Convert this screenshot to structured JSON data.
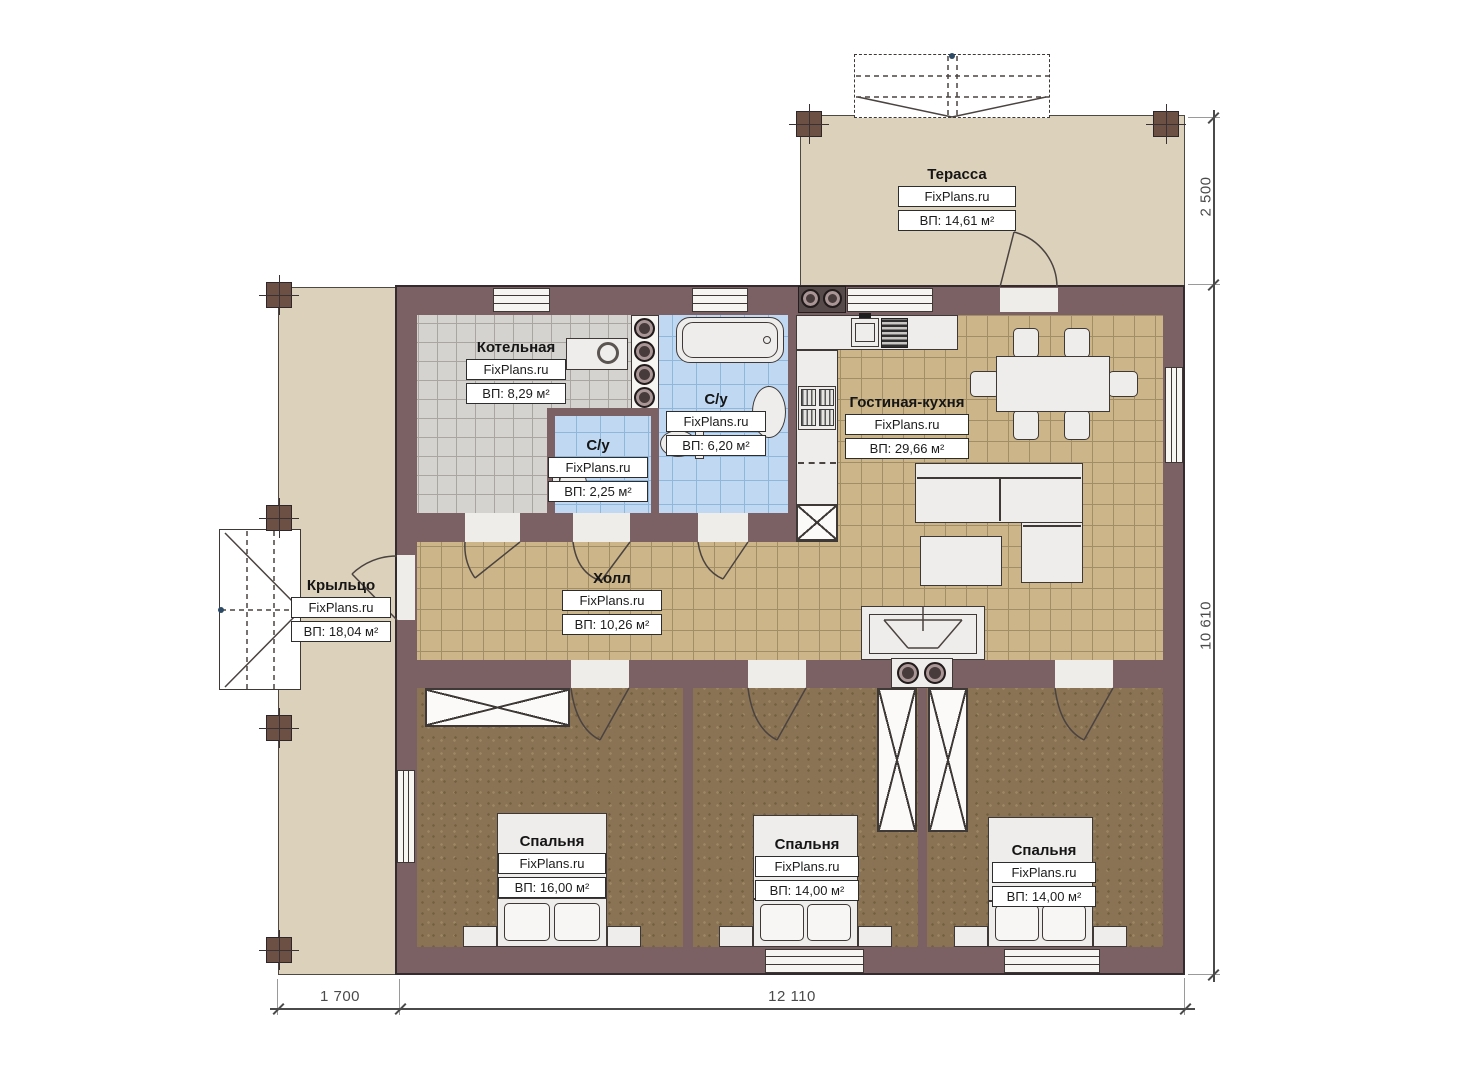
{
  "brand": "FixPlans.ru",
  "rooms": [
    {
      "name": "Терасса",
      "area": "ВП: 14,61 м²"
    },
    {
      "name": "Котельная",
      "area": "ВП: 8,29 м²"
    },
    {
      "name": "С/у",
      "area": "ВП: 6,20 м²"
    },
    {
      "name": "С/у",
      "area": "ВП: 2,25 м²"
    },
    {
      "name": "Гостиная-кухня",
      "area": "ВП: 29,66 м²"
    },
    {
      "name": "Холл",
      "area": "ВП: 10,26 м²"
    },
    {
      "name": "Крыльцо",
      "area": "ВП: 18,04 м²"
    },
    {
      "name": "Спальня",
      "area": "ВП: 16,00 м²"
    },
    {
      "name": "Спальня",
      "area": "ВП: 14,00 м²"
    },
    {
      "name": "Спальня",
      "area": "ВП: 14,00 м²"
    }
  ],
  "dimensions": {
    "terrace_depth": "2 500",
    "house_depth": "10 610",
    "porch_width": "1 700",
    "house_width": "12 110"
  },
  "colors": {
    "wall": "#7b6064",
    "floor_living": "#ccb588",
    "floor_boiler": "#d5d3cf",
    "floor_bath": "#c1d8f2",
    "floor_bedroom": "#8a7355",
    "deck": "#dcd1bb"
  }
}
